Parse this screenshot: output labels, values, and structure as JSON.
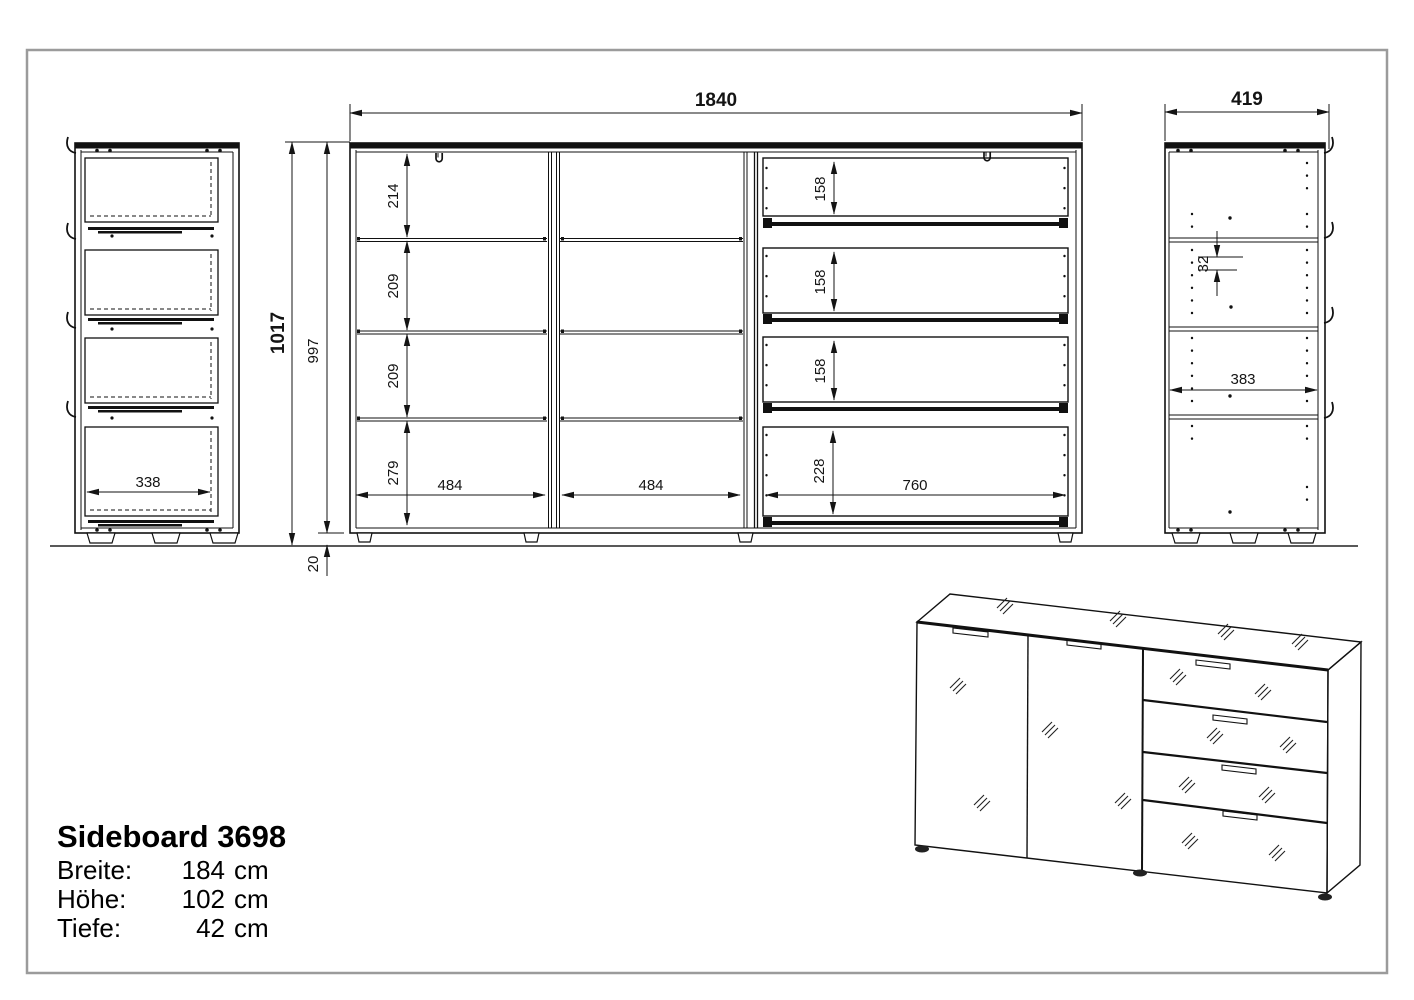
{
  "drawing": {
    "ink": "#141414",
    "border_color": "#9b9b9b"
  },
  "title_block": {
    "model": "Sideboard 3698",
    "specs": [
      {
        "label": "Breite:",
        "value": "184",
        "unit": "cm"
      },
      {
        "label": "Höhe:",
        "value": "102",
        "unit": "cm"
      },
      {
        "label": "Tiefe:",
        "value": "42",
        "unit": "cm"
      }
    ]
  },
  "views": {
    "side_left": {
      "drawer_depth": "338"
    },
    "front": {
      "width": "1840",
      "height_total": "1017",
      "height_body": "997",
      "plinth_height": "20",
      "rows": [
        "214",
        "209",
        "209",
        "279"
      ],
      "cols": [
        "484",
        "484"
      ],
      "drawer_heights": [
        "158",
        "158",
        "158"
      ],
      "drawer_bottom_height": "228",
      "drawer_width": "760"
    },
    "side_right": {
      "depth": "419",
      "hole_pitch": "32",
      "inner_depth": "383"
    }
  }
}
